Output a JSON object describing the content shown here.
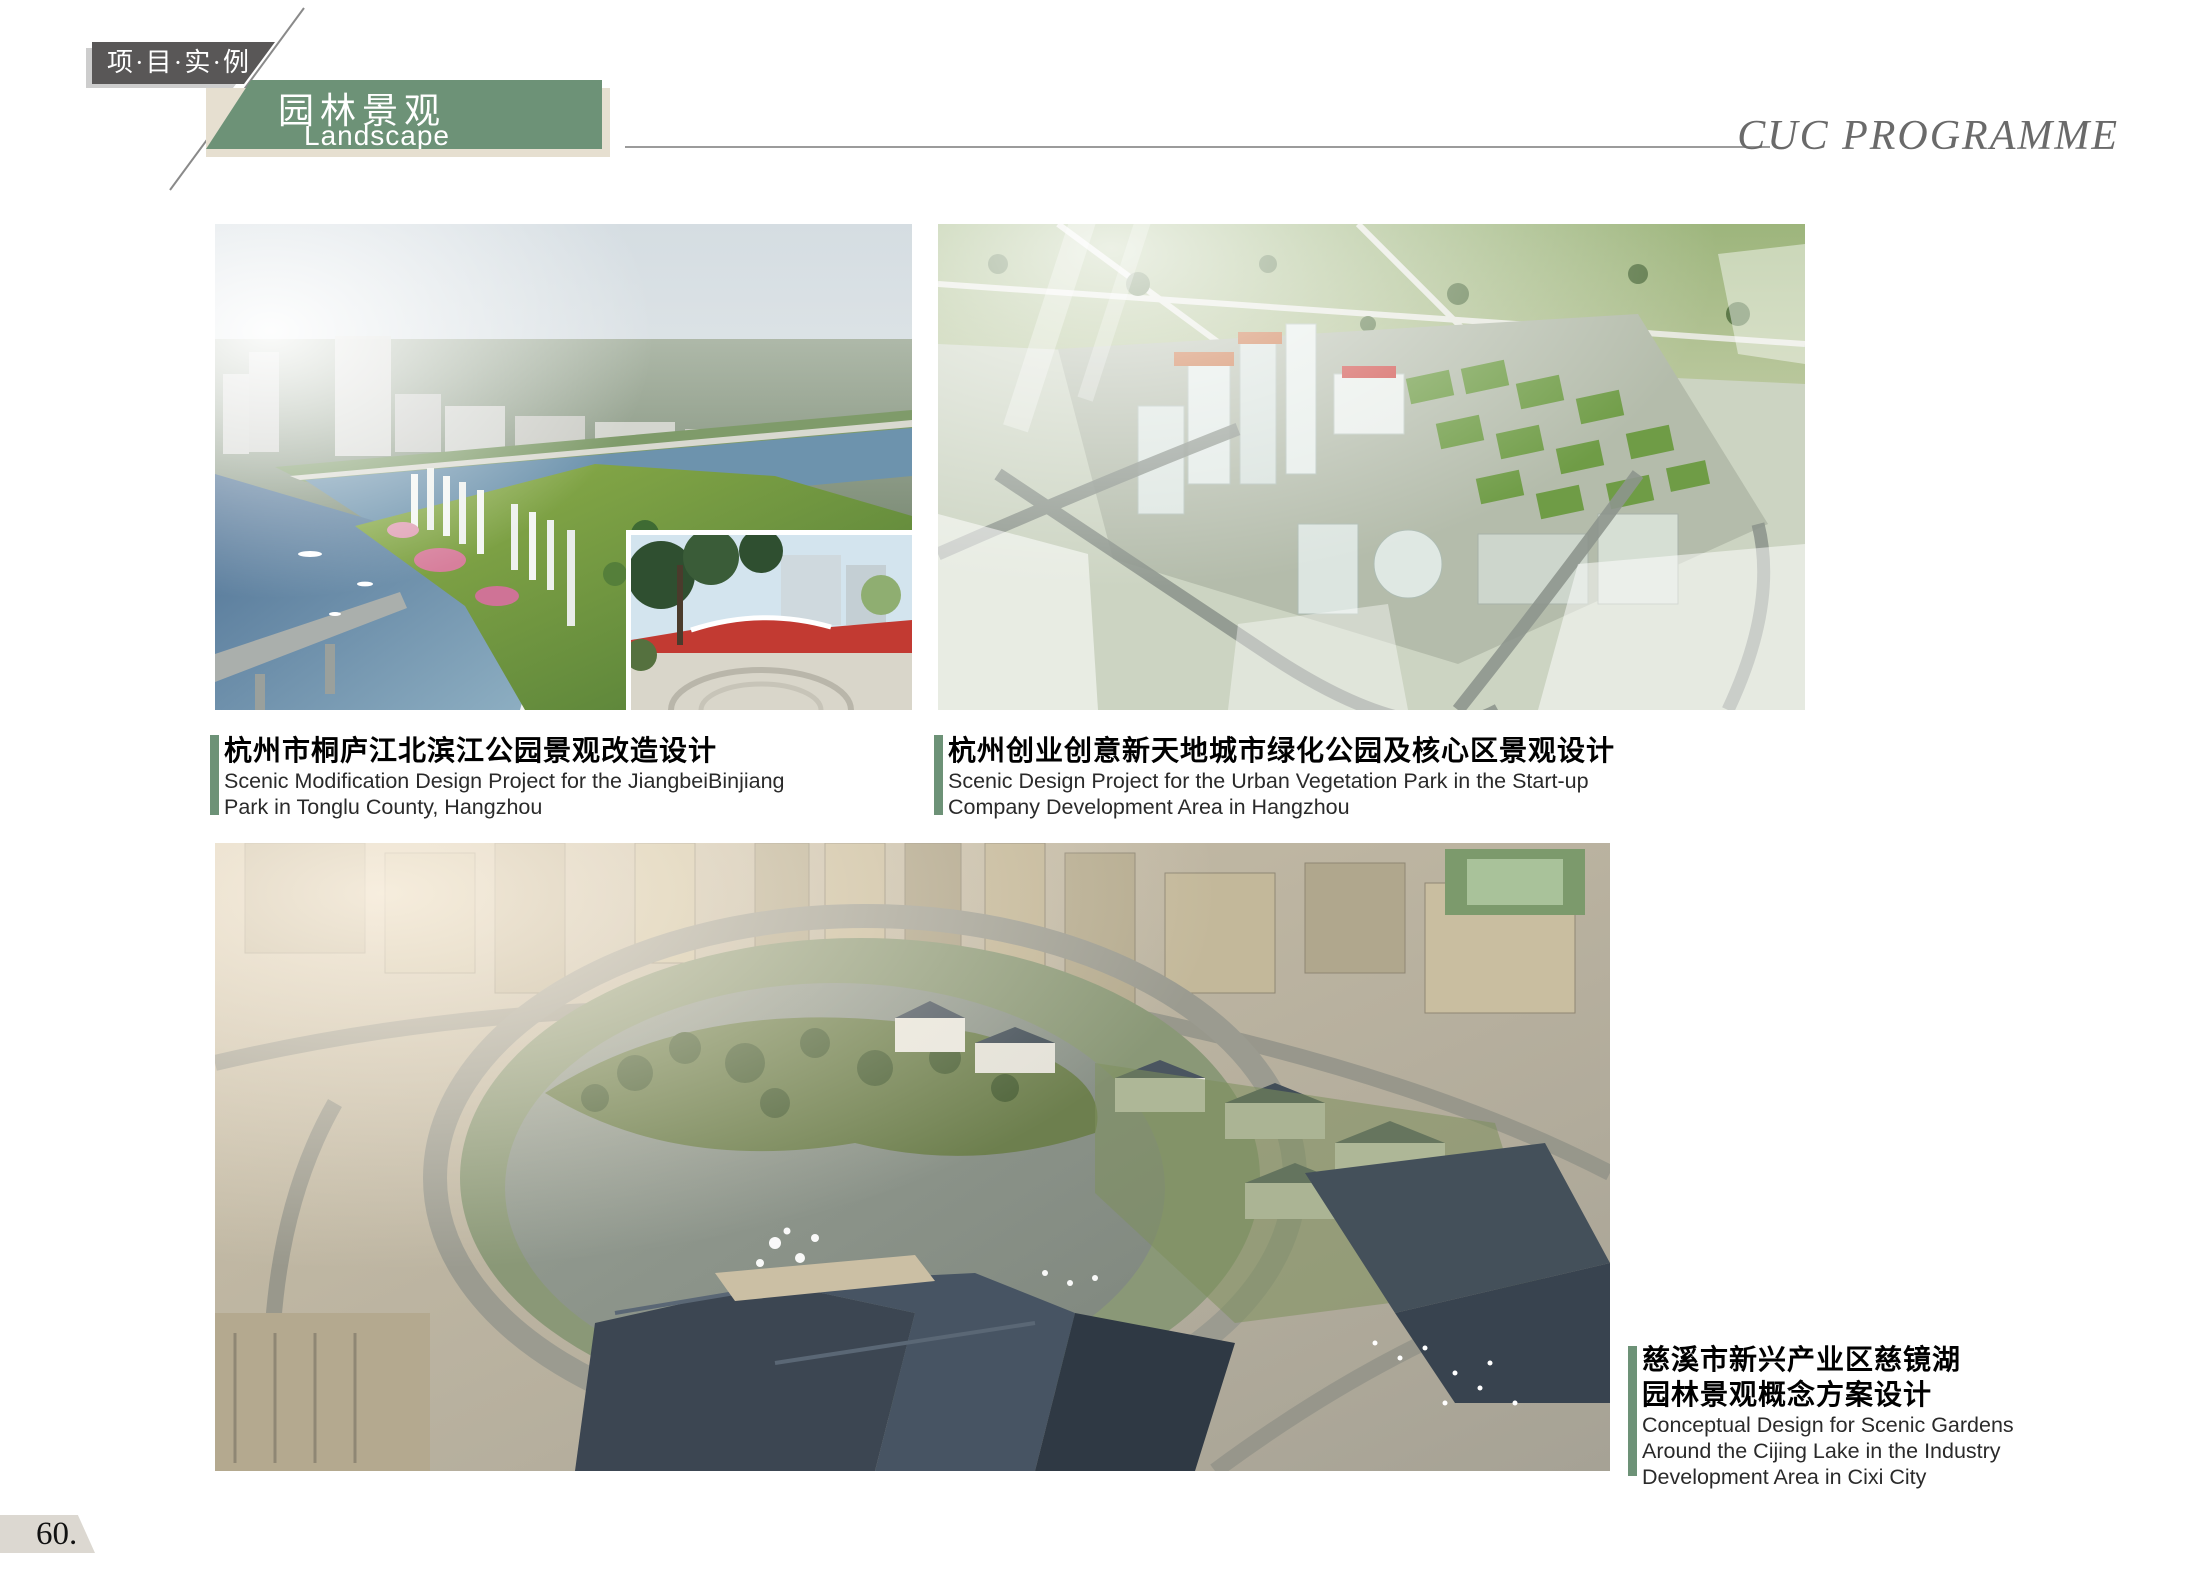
{
  "header": {
    "tab_label": "项·目·实·例",
    "category_zh": "园林景观",
    "category_en": "Landscape Architecture",
    "programme_title": "CUC PROGRAMME"
  },
  "projects": [
    {
      "title_zh_lines": [
        "杭州市桐庐江北滨江公园景观改造设计"
      ],
      "title_en_lines": [
        "Scenic Modification Design Project for the JiangbeiBinjiang",
        "Park in Tonglu County, Hangzhou"
      ]
    },
    {
      "title_zh_lines": [
        "杭州创业创意新天地城市绿化公园及核心区景观设计"
      ],
      "title_en_lines": [
        "Scenic Design Project for the Urban Vegetation Park in the Start-up",
        "Company Development Area in Hangzhou"
      ]
    },
    {
      "title_zh_lines": [
        "慈溪市新兴产业区慈镜湖",
        "园林景观概念方案设计"
      ],
      "title_en_lines": [
        "Conceptual Design for Scenic Gardens",
        "Around the Cijing Lake in the Industry",
        "Development Area in Cixi City"
      ]
    }
  ],
  "footer": {
    "page_number": "60."
  },
  "colors": {
    "accent_green": "#6d9277",
    "tab_gray": "#595757",
    "shadow_tan": "#e6dfd0",
    "programme_gray": "#6a6a6a"
  }
}
